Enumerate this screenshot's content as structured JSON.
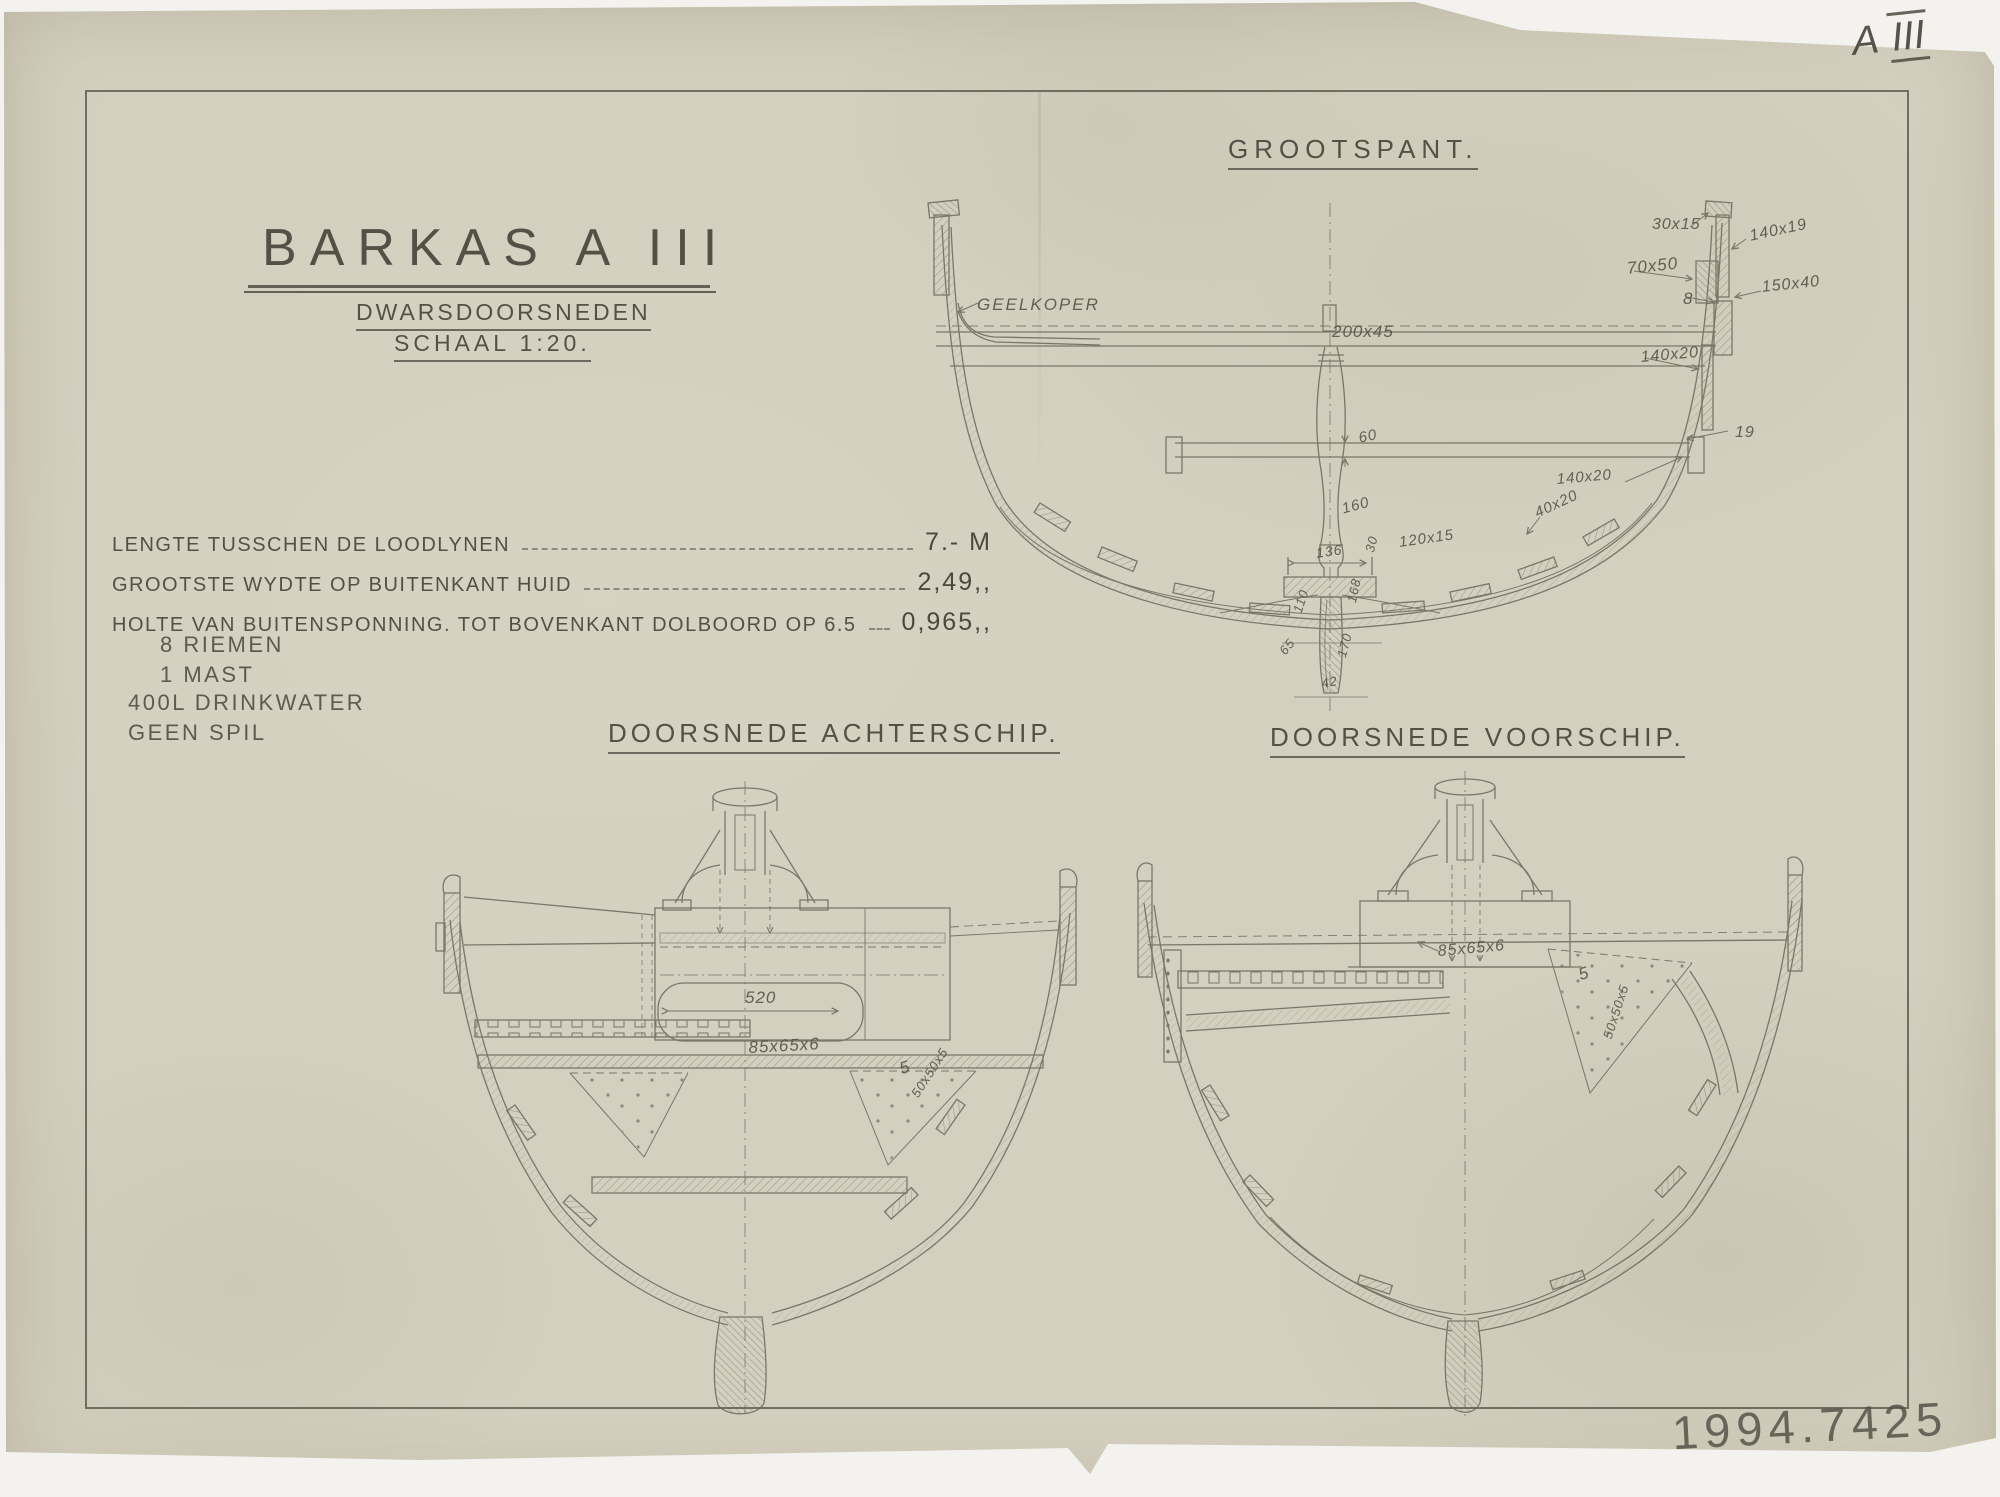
{
  "page": {
    "corner_letter": "A",
    "corner_numeral": "III",
    "inventory_number": "1994.7425"
  },
  "title_block": {
    "title": "BARKAS A III",
    "subtitle": "DWARSDOORSNEDEN",
    "scale": "SCHAAL 1:20."
  },
  "specs": [
    {
      "label": "LENGTE TUSSCHEN DE LOODLYNEN",
      "value": "7.- M"
    },
    {
      "label": "GROOTSTE WYDTE OP BUITENKANT HUID",
      "value": "2,49,,"
    },
    {
      "label": "HOLTE VAN BUITENSPONNING. TOT BOVENKANT DOLBOORD OP 6.5",
      "value": "0,965,,"
    }
  ],
  "equipment": {
    "riemen": "8 RIEMEN",
    "mast": "1 MAST",
    "drinkwater": "400L DRINKWATER",
    "spil": "GEEN SPIL"
  },
  "grootspant": {
    "title": "GROOTSPANT.",
    "labels": {
      "geelkoper": "GEELKOPER",
      "thwart": "200x45",
      "gunwale_cap": "30x15",
      "rubrail": "140x19",
      "inwale": "70x50",
      "plank8": "8",
      "rail150": "150x40",
      "clamp140": "140x20",
      "plank19": "19",
      "dim60": "60",
      "dim160": "160",
      "dim30": "30",
      "floor120": "120x15",
      "bilge40": "40x20",
      "riser140": "140x20",
      "dim136": "136",
      "dim110": "110",
      "dim168": "168",
      "dim170": "170",
      "dim65": "65",
      "dim42": "42"
    }
  },
  "achterschip": {
    "title": "DOORSNEDE ACHTERSCHIP.",
    "labels": {
      "dim520": "520",
      "angle_bar": "85x65x6",
      "dim5": "5",
      "gusset": "50x50x5"
    }
  },
  "voorschip": {
    "title": "DOORSNEDE VOORSCHIP.",
    "labels": {
      "angle_bar": "85x65x6",
      "dim5": "5",
      "gusset": "50x50x5"
    }
  }
}
